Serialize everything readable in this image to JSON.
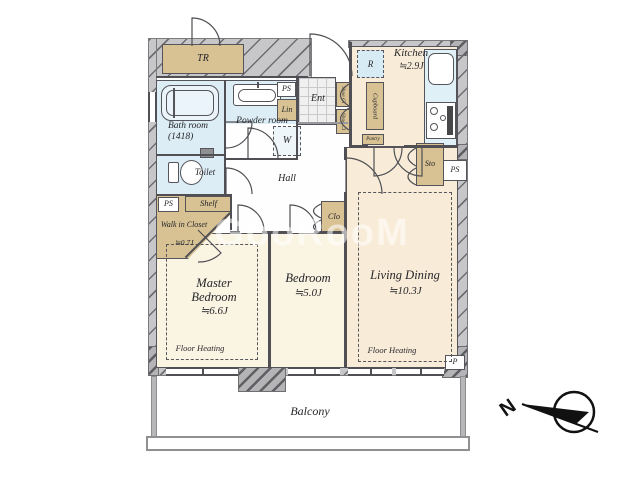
{
  "watermark": {
    "text": "GooRooM"
  },
  "compass": {
    "north": "N"
  },
  "plan": {
    "tr": "TR",
    "kitchen": {
      "name": "Kitchen",
      "size": "≒2.9J"
    },
    "fridge": "R",
    "cupboard": "Cupboard",
    "pantry": "Pantry",
    "shoe_cl_1": "Shoe Cl",
    "shoe_cl_2": "Shoe Cl",
    "entrance": "Ent",
    "ps_powder": "PS",
    "linen": "Lin",
    "washer": "W",
    "powder": "Powder room",
    "bath": "Bath room (1418)",
    "toilet": "Toilet",
    "hall": "Hall",
    "ps_wic": "PS",
    "shelf": "Shelf",
    "wic": {
      "name": "Walk in Closet",
      "size": "≒0.7J"
    },
    "clo": "Clo",
    "sto": "Sto",
    "ps_kitchen": "PS",
    "living": {
      "name": "Living Dining",
      "size": "≒10.3J"
    },
    "master": {
      "name": "Master Bedroom",
      "size": "≒6.6J"
    },
    "bedroom": {
      "name": "Bedroom",
      "size": "≒5.0J"
    },
    "floor_heating": "Floor Heating",
    "pipe": "P",
    "balcony": "Balcony"
  }
}
